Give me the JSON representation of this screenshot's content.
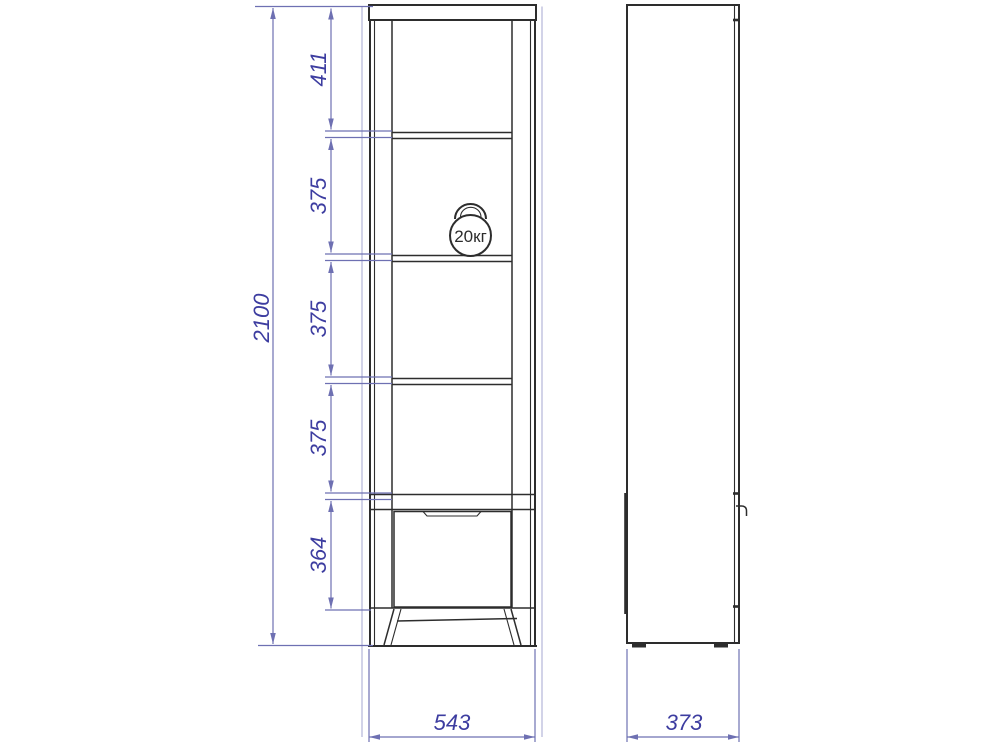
{
  "drawing": {
    "overall_height_mm": "2100",
    "section_heights_mm": [
      "411",
      "375",
      "375",
      "375",
      "364"
    ],
    "front_width_mm": "543",
    "side_depth_mm": "373",
    "shelf_load_label": "20кг"
  },
  "colors": {
    "line": "#2d2d2d",
    "dimension_line": "#6e70b2",
    "dimension_text": "#3d3da0",
    "background": "#ffffff"
  }
}
